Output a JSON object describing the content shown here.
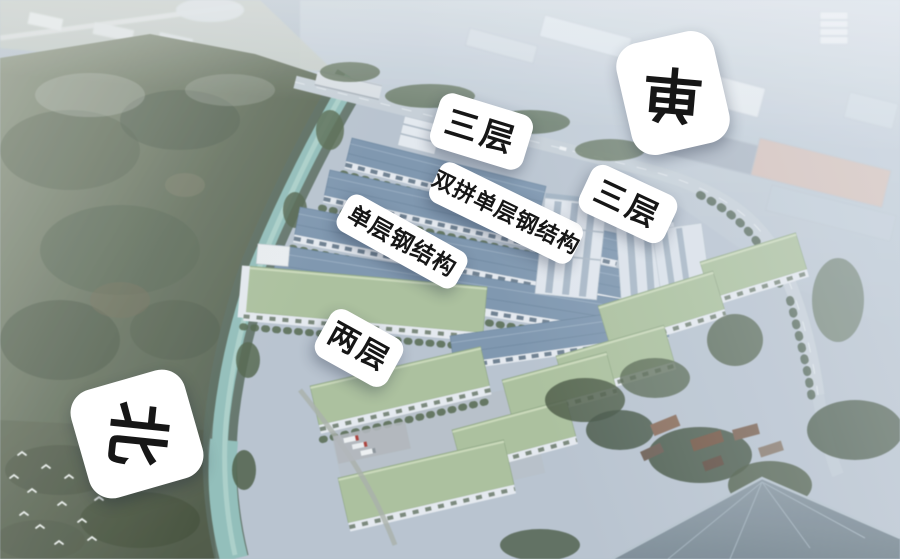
{
  "annotations": {
    "building_labels": [
      {
        "id": "three-floors-top",
        "text": "三层"
      },
      {
        "id": "duplex-single-steel",
        "text": "双拼单层钢结构"
      },
      {
        "id": "three-floors-right",
        "text": "三层"
      },
      {
        "id": "single-steel",
        "text": "单层钢结构"
      },
      {
        "id": "two-floors",
        "text": "两层"
      }
    ],
    "markers": {
      "north": "北",
      "single": "单"
    }
  },
  "colors": {
    "label_background": "#ffffff",
    "label_text": "#161616",
    "roof_blue": "#7b95af",
    "roof_green": "#abc29a",
    "river_teal": "#8fc0ba",
    "hillside_green": "#66755c",
    "haze_blue": "#c3ced9",
    "big_roof_grey": "#72828f"
  }
}
